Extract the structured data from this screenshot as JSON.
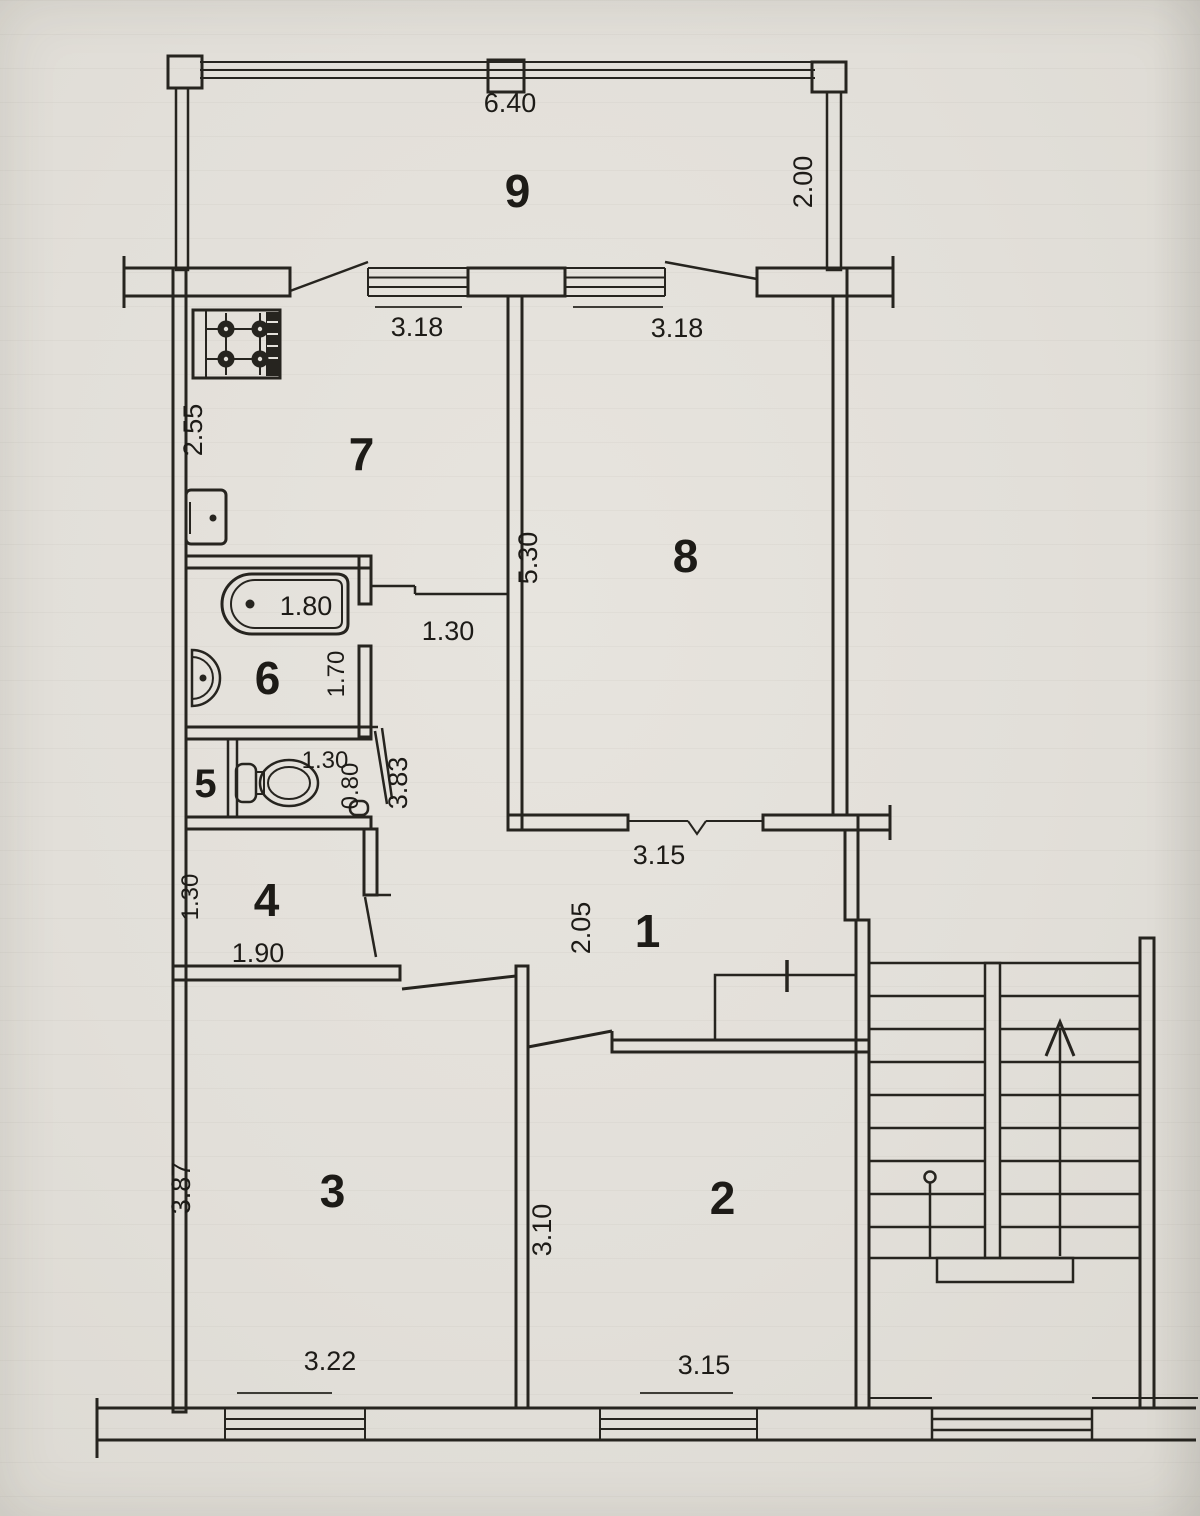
{
  "document_type": "apartment floor plan scan",
  "colors": {
    "paper": "#e3e0da",
    "ink": "#26241f"
  },
  "labels": {
    "room1": "1",
    "room2": "2",
    "room3": "3",
    "room4": "4",
    "room5": "5",
    "room6": "6",
    "room7": "7",
    "room8": "8",
    "room9": "9",
    "balcony_width": "6.40",
    "balcony_depth": "2.00",
    "kitchen_window": "3.18",
    "room8_window": "3.18",
    "kitchen_depth": "2.55",
    "room8_depth": "5.30",
    "tub_length": "1.80",
    "bath_depth": "1.70",
    "passage_width": "1.30",
    "wc_width": "1.30",
    "wc_depth": "0.80",
    "corridor_length": "3.83",
    "room4_depth": "1.30",
    "room4_width": "1.90",
    "room8_door_wall": "3.15",
    "hall_depth": "2.05",
    "room3_depth": "3.87",
    "room3_window": "3.22",
    "room2_depth": "3.10",
    "room2_window": "3.15"
  }
}
